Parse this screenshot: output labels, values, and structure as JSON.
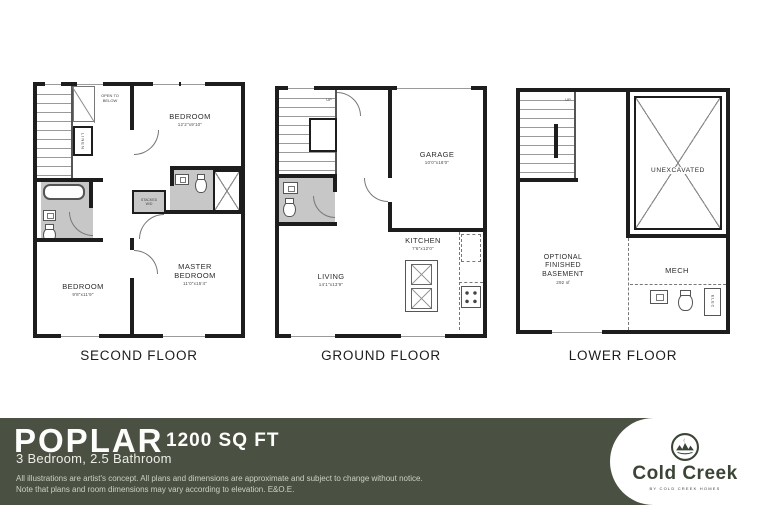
{
  "plans": [
    {
      "label": "SECOND FLOOR",
      "rooms": {
        "bedroom_top": {
          "name": "BEDROOM",
          "dims": "12'2\"x9'10\""
        },
        "bedroom_left": {
          "name": "BEDROOM",
          "dims": "9'8\"x11'9\""
        },
        "master": {
          "name": "MASTER BEDROOM",
          "dims": "11'0\"x15'4\""
        },
        "linen": "LINEN",
        "open_to_below": "OPEN TO BELOW",
        "stacked_wd": "STACKED W/D"
      }
    },
    {
      "label": "GROUND FLOOR",
      "rooms": {
        "garage": {
          "name": "GARAGE",
          "dims": "10'0\"x18'0\""
        },
        "kitchen": {
          "name": "KITCHEN",
          "dims": "7'6\"x12'0\""
        },
        "living": {
          "name": "LIVING",
          "dims": "14'1\"x13'9\""
        },
        "up": "UP"
      }
    },
    {
      "label": "LOWER FLOOR",
      "rooms": {
        "unexcavated": "UNEXCAVATED",
        "basement": {
          "name": "OPTIONAL FINISHED BASEMENT",
          "dims": "292 sf"
        },
        "mech": "MECH",
        "up": "UP",
        "elec": "ELEC"
      }
    }
  ],
  "footer": {
    "plan_name": "POPLAR",
    "area": "1200 SQ FT",
    "specs": "3 Bedroom, 2.5 Bathroom",
    "disclaimer_line1": "All illustrations are artist's concept. All plans and dimensions are approximate and subject to change without notice.",
    "disclaimer_line2": "Note that plans and room dimensions may vary according to elevation. E&O.E.",
    "brand_name": "Cold Creek",
    "brand_tagline": "BY COLD CREEK HOMES"
  },
  "colors": {
    "footer_bg": "#4a5143",
    "wall": "#1d1d1d",
    "bath_floor": "#c7c7c7",
    "brand_green": "#3b4536"
  }
}
